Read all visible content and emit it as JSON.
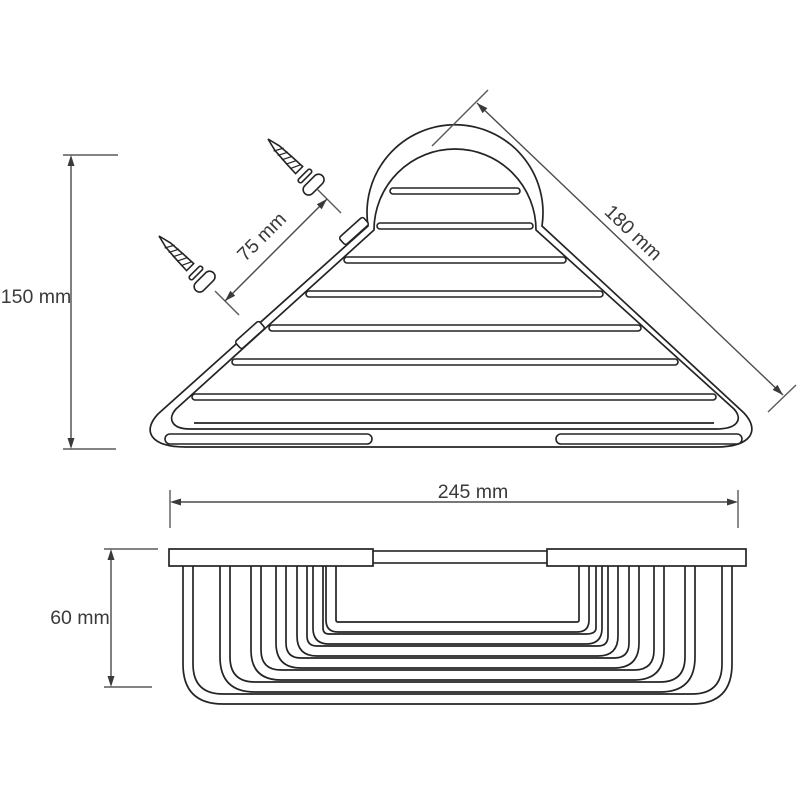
{
  "diagram": {
    "description": "Corner shower basket technical drawing, two views",
    "line_color": "#242424",
    "background": "#ffffff",
    "dims": {
      "height": {
        "label": "150 mm"
      },
      "offset": {
        "label": "75 mm"
      },
      "side": {
        "label": "180 mm"
      },
      "width": {
        "label": "245 mm"
      },
      "depth": {
        "label": "60 mm"
      }
    }
  }
}
